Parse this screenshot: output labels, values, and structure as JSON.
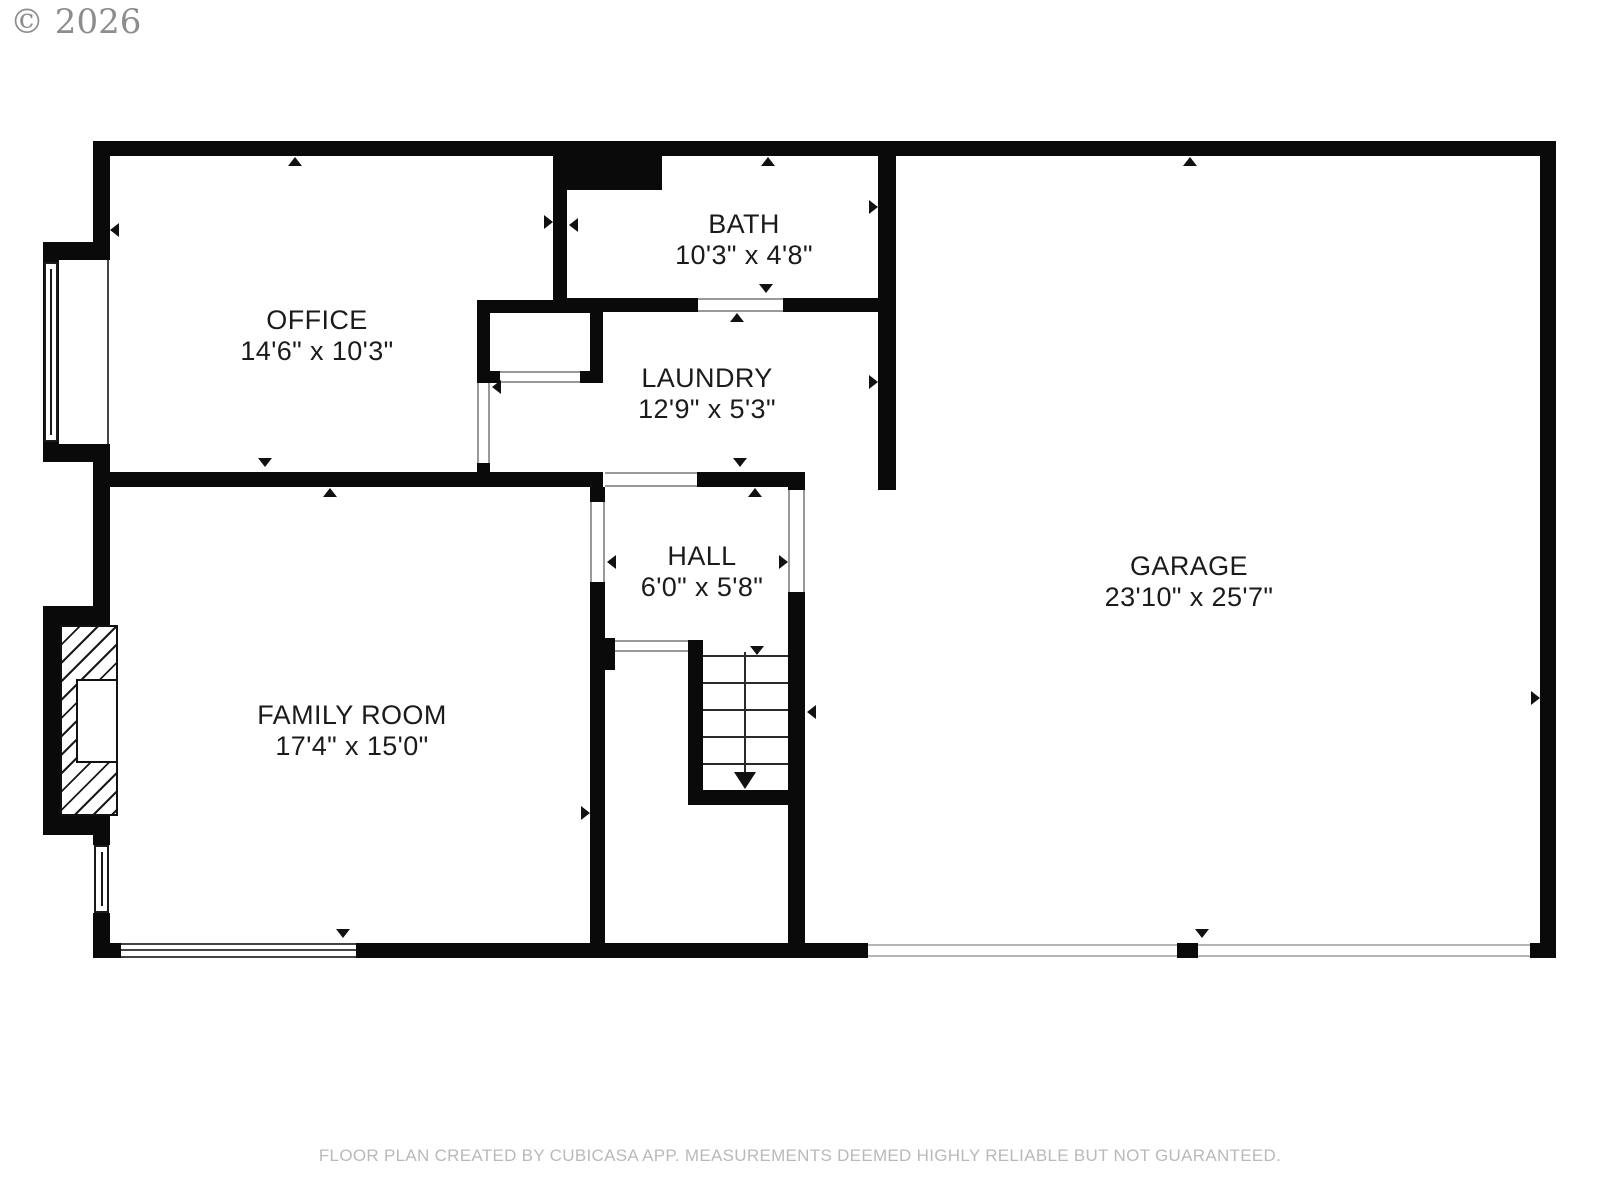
{
  "copyright": "© 2026",
  "footer": "FLOOR PLAN CREATED BY CUBICASA APP. MEASUREMENTS DEEMED HIGHLY RELIABLE BUT NOT GUARANTEED.",
  "colors": {
    "wall": "#0a0a0a",
    "text": "#1b1b1b",
    "copyright": "#8d8d8d",
    "footer": "#b9b9b9"
  },
  "rooms": [
    {
      "name": "OFFICE",
      "dims": "14'6\" x 10'3\""
    },
    {
      "name": "BATH",
      "dims": "10'3\" x 4'8\""
    },
    {
      "name": "LAUNDRY",
      "dims": "12'9\" x 5'3\""
    },
    {
      "name": "HALL",
      "dims": "6'0\" x 5'8\""
    },
    {
      "name": "FAMILY ROOM",
      "dims": "17'4\" x 15'0\""
    },
    {
      "name": "GARAGE",
      "dims": "23'10\" x 25'7\""
    }
  ]
}
